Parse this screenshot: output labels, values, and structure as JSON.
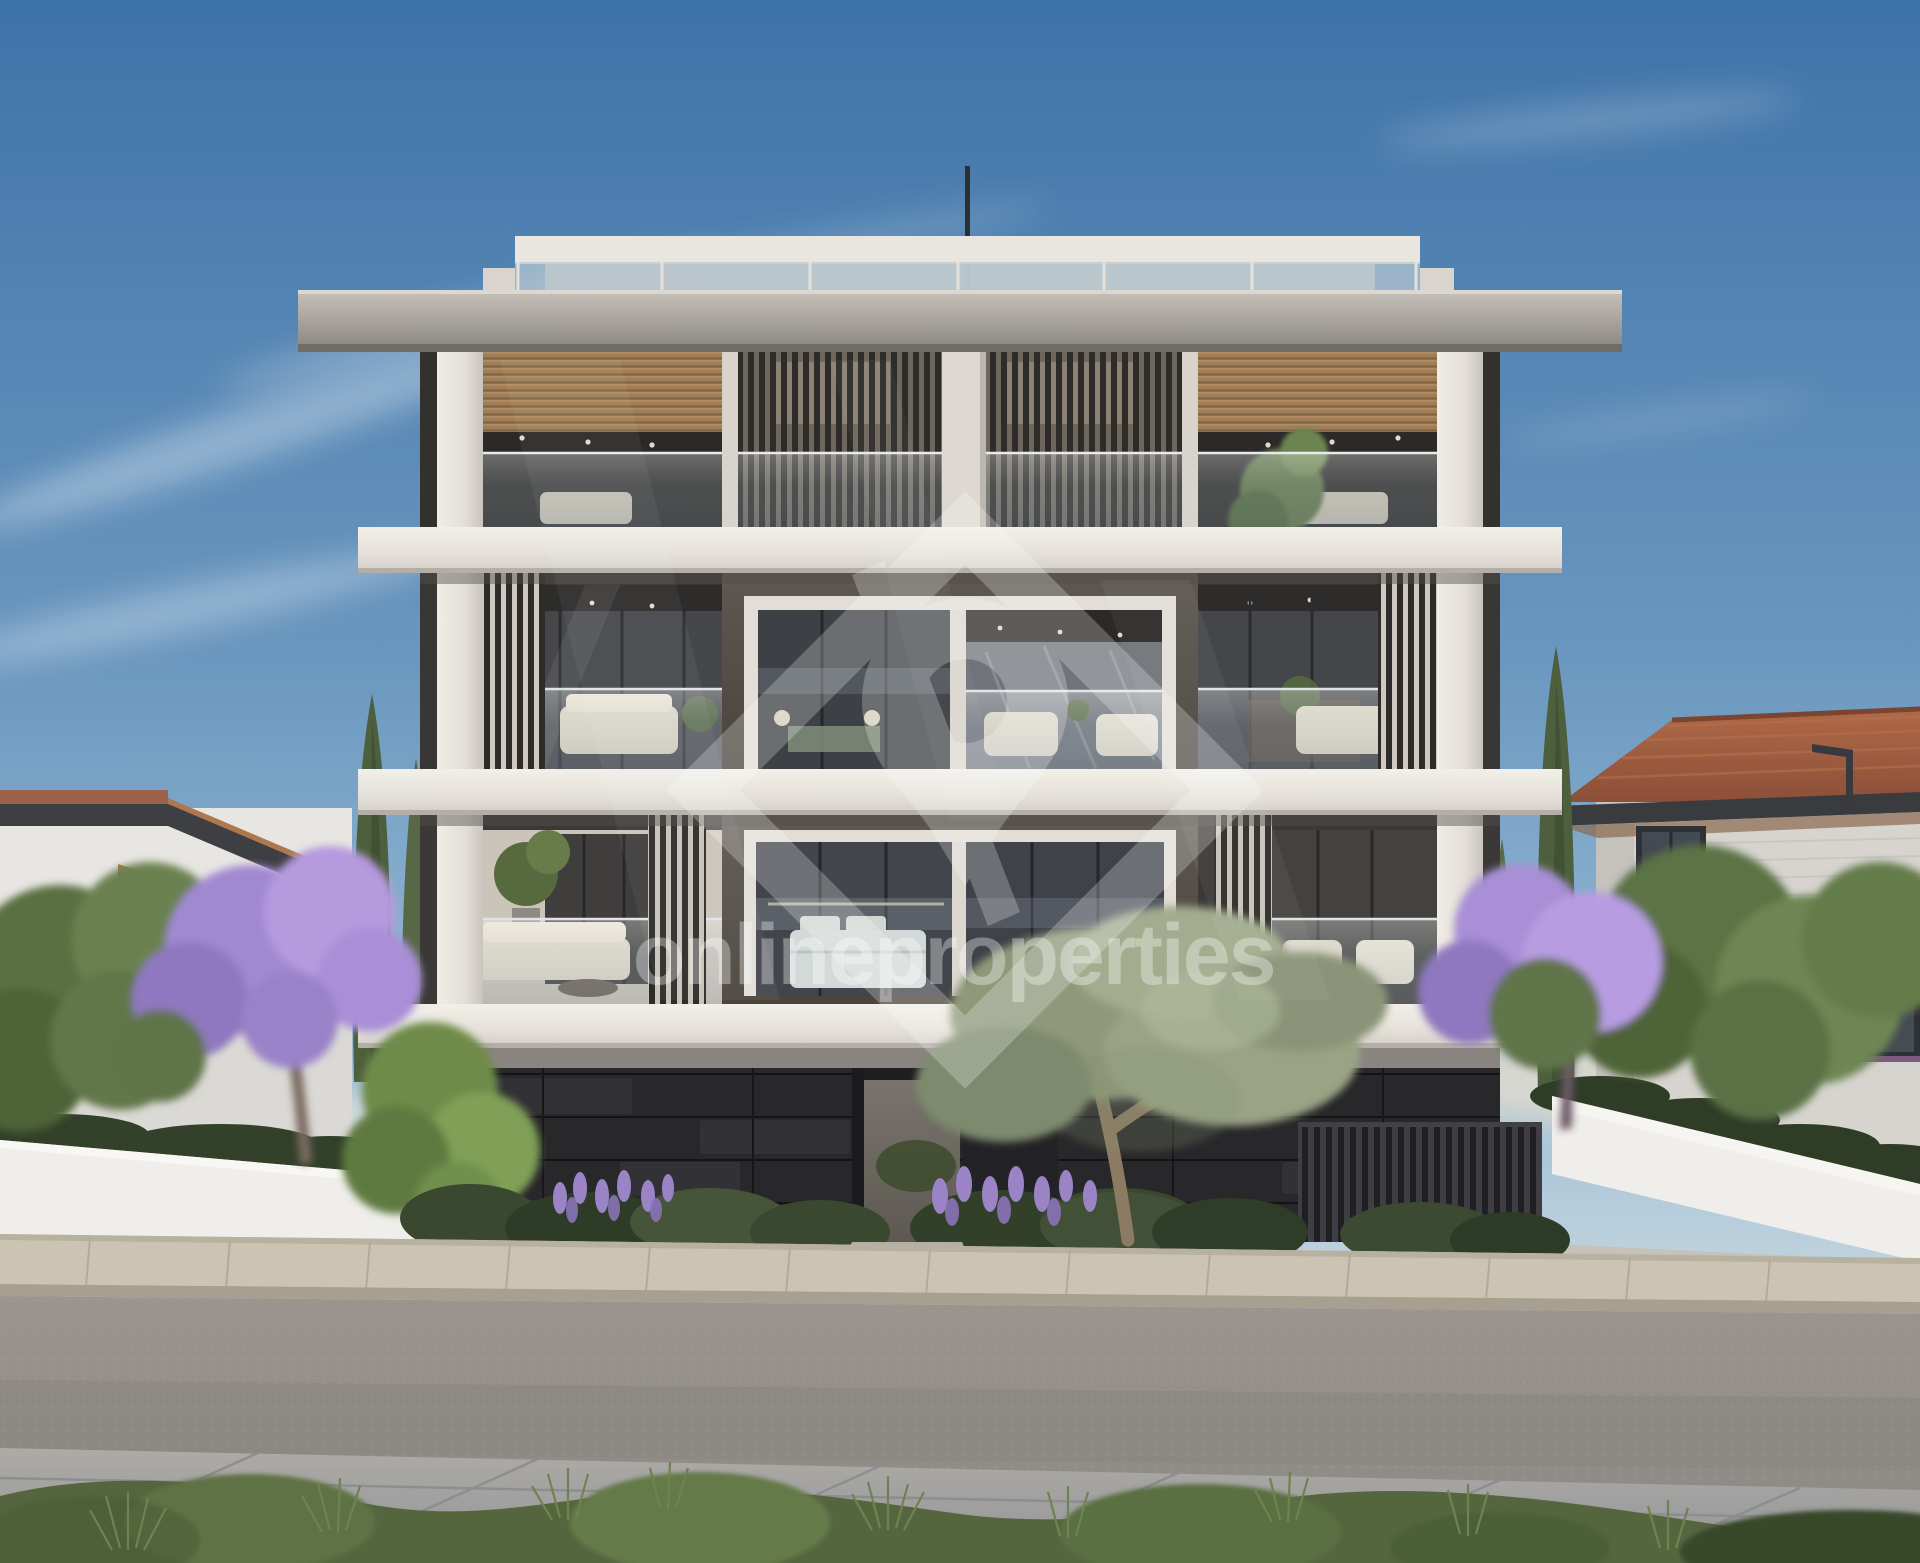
{
  "scene": {
    "type": "architectural-exterior-render",
    "description": "Street-front render of a modern three-storey apartment block with dark stone base, white concrete slabs, timber soffits, vertical louvre screens, glass balustrades, flowering jacaranda trees, olive tree, cypresses and neighbouring houses under a clear blue sky",
    "time_of_day": "late afternoon, clear sky"
  },
  "watermark": {
    "text": "onlineproperties",
    "logo": "house-pin-diamond",
    "color": "#ffffff",
    "text_opacity": 0.34,
    "logo_opacity": 0.24
  },
  "palette": {
    "sky_top": "#3e73a8",
    "sky_mid": "#6f9cc2",
    "sky_low": "#a6c4da",
    "sky_horizon": "#dde5e6",
    "concrete": "#e9e6df",
    "concrete_shade": "#cfccc5",
    "roof_slab": "#a8a49d",
    "wood_soffit": "#a07e57",
    "louver": "#2e2c29",
    "interior_dark": "#33312e",
    "glass_dark": "#44474c",
    "bronze_frame": "#57514b",
    "white_frame": "#e2ded7",
    "base_charcoal": "#28272a",
    "fence_dark": "#202023",
    "entry_path": "#b3aea6",
    "sidewalk_far": "#ccc4b2",
    "curb": "#a79f90",
    "road": "#949089",
    "pavement_near": "#a3a4a3",
    "grass": "#55663f",
    "bush": "#3a4830",
    "lavender": "#9b84c6",
    "olive_foliage": "#8f9879",
    "jacaranda": "#a88fd6",
    "tree_green": "#5c7344",
    "cypress": "#4d5f3c",
    "roof_tile": "#a05c40",
    "house_left_wall": "#e8e6e2",
    "house_right_wall": "#d7d4d0",
    "eave_dark": "#3a3b3e",
    "boundary_wall": "#efeeea",
    "cream_sofa": "#e0d8c6",
    "watermark_color": "#ffffff"
  }
}
